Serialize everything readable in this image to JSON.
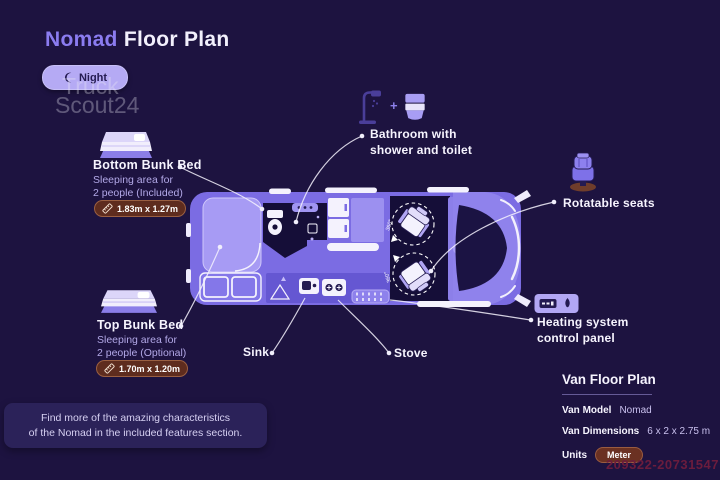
{
  "title": {
    "brand": "Nomad",
    "rest": " Floor Plan"
  },
  "toggle": {
    "label": "Night"
  },
  "watermark": {
    "line1": "Truck",
    "line2": "Scout24"
  },
  "callouts": {
    "bottom_bunk": {
      "title": "Bottom Bunk Bed",
      "desc1": "Sleeping area for",
      "desc2": "2 people (Included)",
      "badge": "1.83m x 1.27m"
    },
    "top_bunk": {
      "title": "Top Bunk Bed",
      "desc1": "Sleeping area for",
      "desc2": "2 people (Optional)",
      "badge": "1.70m x 1.20m"
    },
    "bathroom": {
      "plus": "+",
      "line1": "Bathroom with",
      "line2": "shower and toilet"
    },
    "rotatable_seats": {
      "label": "Rotatable seats"
    },
    "heating": {
      "line1": "Heating system",
      "line2": "control panel"
    },
    "sink": {
      "label": "Sink"
    },
    "stove": {
      "label": "Stove"
    }
  },
  "diagram": {
    "rotation_label": "360°"
  },
  "footer_note": {
    "line1": "Find more of the amazing characteristics",
    "line2": "of the Nomad in the included features section."
  },
  "spec_panel": {
    "title": "Van Floor Plan",
    "rows": [
      {
        "label": "Van Model",
        "value": "Nomad"
      },
      {
        "label": "Van Dimensions",
        "value": "6 x 2 x 2.75 m"
      },
      {
        "label": "Units",
        "value": "Meter"
      }
    ]
  },
  "photo_id": "209322-20731547",
  "colors": {
    "background": "#1d1340",
    "accent_purple": "#8b7cf0",
    "van_body": "#7b6ce3",
    "badge_brown": "#5e2c1e",
    "night_pill": "#b5aaf4"
  }
}
